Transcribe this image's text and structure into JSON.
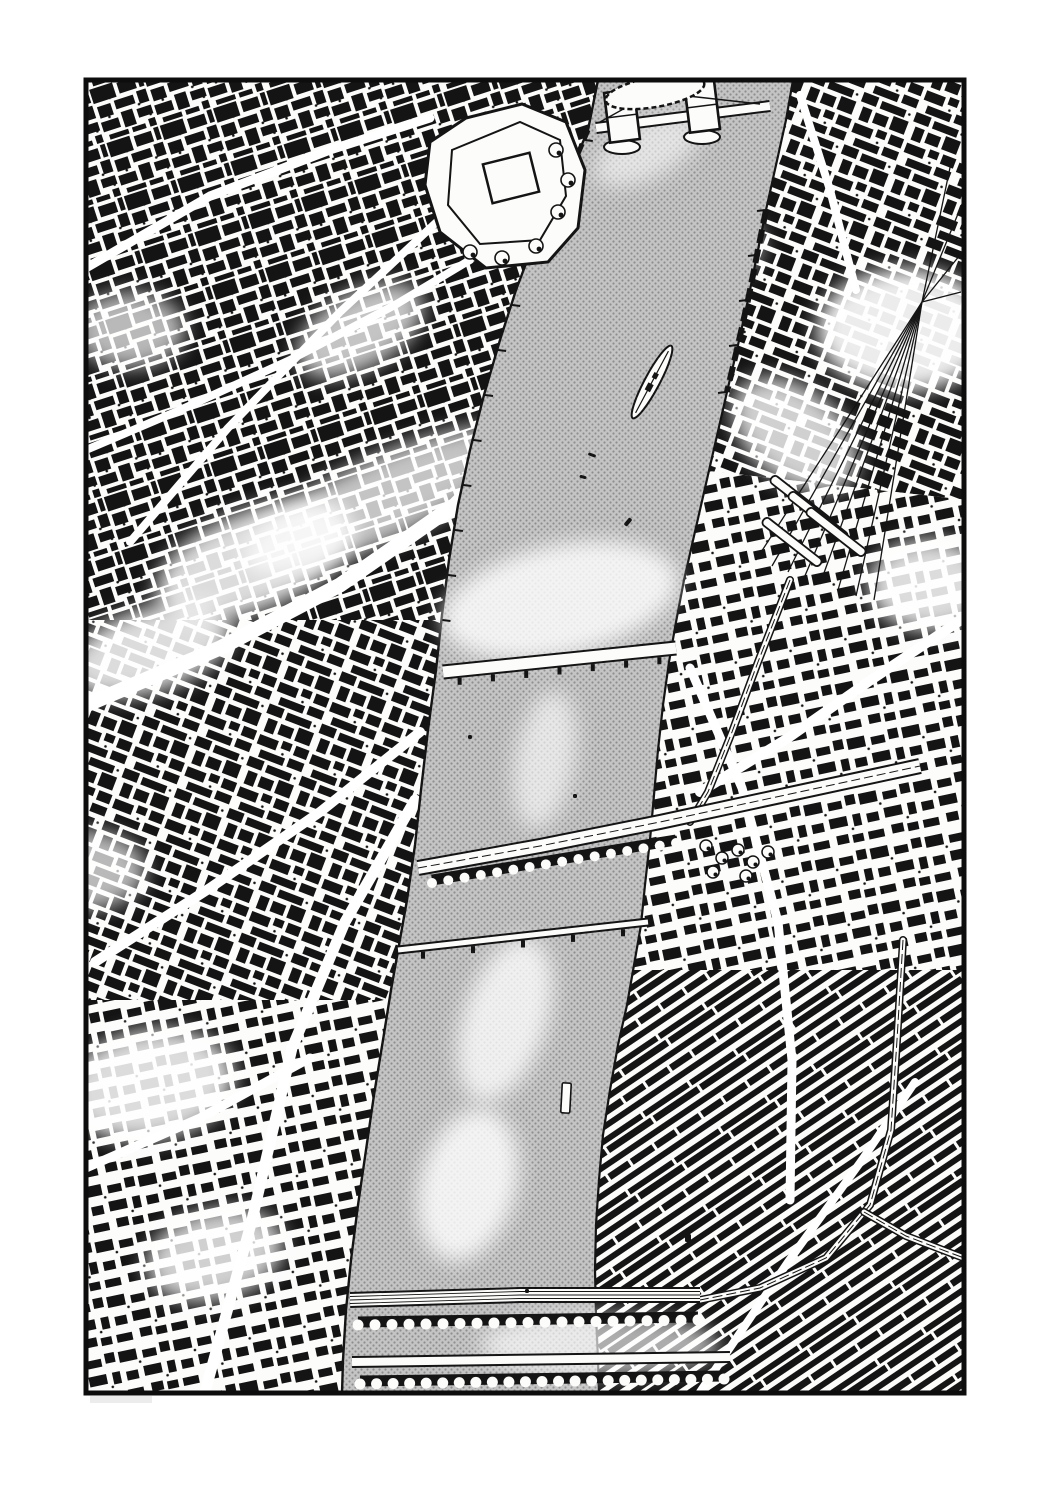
{
  "scene": {
    "type": "aerial-ink-illustration",
    "description": "Black-and-white pen-and-ink aerial panorama of a city bisected by a broad halftone river. A twin-towered bascule bridge and a walled castle compound sit at the top, a moored warship lies on the right bank, a fan of railway tracks feeds a station on the right, and arched rail and road bridges cross near the bottom. Dense hand-drawn city blocks fill both banks inside a black panel border."
  },
  "colors": {
    "ink": "#141414",
    "paper": "#fcfcfb",
    "river_base": "#c4c4c4",
    "river_dot": "#8d8d8d",
    "highlight": "#ffffff",
    "smudge": "#ececec",
    "frame": "#0d0d0d"
  },
  "frame": {
    "x": 86,
    "y": 80,
    "width": 878,
    "height": 1313,
    "border_width": 5
  },
  "river": {
    "left_bank": [
      [
        598,
        80
      ],
      [
        588,
        130
      ],
      [
        572,
        168
      ],
      [
        552,
        205
      ],
      [
        533,
        245
      ],
      [
        516,
        290
      ],
      [
        500,
        340
      ],
      [
        484,
        395
      ],
      [
        470,
        450
      ],
      [
        458,
        505
      ],
      [
        449,
        560
      ],
      [
        442,
        615
      ],
      [
        436,
        670
      ],
      [
        428,
        730
      ],
      [
        421,
        790
      ],
      [
        415,
        845
      ],
      [
        407,
        900
      ],
      [
        399,
        945
      ],
      [
        391,
        990
      ],
      [
        383,
        1040
      ],
      [
        374,
        1095
      ],
      [
        366,
        1150
      ],
      [
        358,
        1205
      ],
      [
        351,
        1260
      ],
      [
        346,
        1310
      ],
      [
        343,
        1360
      ],
      [
        342,
        1393
      ]
    ],
    "right_bank": [
      [
        793,
        80
      ],
      [
        786,
        120
      ],
      [
        776,
        165
      ],
      [
        766,
        210
      ],
      [
        757,
        255
      ],
      [
        748,
        300
      ],
      [
        738,
        345
      ],
      [
        727,
        392
      ],
      [
        716,
        440
      ],
      [
        705,
        488
      ],
      [
        694,
        536
      ],
      [
        684,
        580
      ],
      [
        676,
        622
      ],
      [
        669,
        662
      ],
      [
        663,
        705
      ],
      [
        658,
        750
      ],
      [
        654,
        795
      ],
      [
        650,
        840
      ],
      [
        645,
        885
      ],
      [
        641,
        925
      ],
      [
        634,
        965
      ],
      [
        627,
        1005
      ],
      [
        618,
        1045
      ],
      [
        610,
        1090
      ],
      [
        603,
        1135
      ],
      [
        599,
        1180
      ],
      [
        596,
        1225
      ],
      [
        595,
        1270
      ],
      [
        596,
        1315
      ],
      [
        598,
        1360
      ],
      [
        599,
        1393
      ]
    ]
  },
  "land_regions": [
    {
      "name": "northwest-blocks",
      "pattern": "a",
      "points": [
        [
          83,
          78
        ],
        [
          640,
          78
        ],
        [
          540,
          400
        ],
        [
          470,
          620
        ],
        [
          83,
          620
        ]
      ]
    },
    {
      "name": "west-blocks",
      "pattern": "b",
      "points": [
        [
          83,
          620
        ],
        [
          470,
          620
        ],
        [
          430,
          1000
        ],
        [
          83,
          1000
        ]
      ]
    },
    {
      "name": "southwest-blocks",
      "pattern": "d",
      "points": [
        [
          83,
          1000
        ],
        [
          430,
          1000
        ],
        [
          370,
          1396
        ],
        [
          83,
          1396
        ]
      ]
    },
    {
      "name": "northeast-blocks",
      "pattern": "b",
      "points": [
        [
          760,
          78
        ],
        [
          967,
          78
        ],
        [
          967,
          500
        ],
        [
          700,
          470
        ]
      ]
    },
    {
      "name": "east-blocks",
      "pattern": "d",
      "points": [
        [
          700,
          470
        ],
        [
          967,
          500
        ],
        [
          967,
          970
        ],
        [
          600,
          970
        ]
      ]
    },
    {
      "name": "southeast-terraces",
      "pattern": "c",
      "points": [
        [
          600,
          970
        ],
        [
          967,
          970
        ],
        [
          967,
          1396
        ],
        [
          560,
          1396
        ]
      ]
    }
  ],
  "roads": [
    {
      "width": 9,
      "points": [
        [
          86,
          268
        ],
        [
          210,
          196
        ],
        [
          330,
          150
        ],
        [
          430,
          118
        ]
      ]
    },
    {
      "width": 15,
      "points": [
        [
          86,
          705
        ],
        [
          220,
          648
        ],
        [
          340,
          585
        ],
        [
          455,
          505
        ],
        [
          520,
          440
        ]
      ]
    },
    {
      "width": 10,
      "points": [
        [
          95,
          962
        ],
        [
          210,
          888
        ],
        [
          320,
          812
        ],
        [
          420,
          732
        ]
      ]
    },
    {
      "width": 11,
      "points": [
        [
          205,
          1392
        ],
        [
          252,
          1220
        ],
        [
          292,
          1048
        ],
        [
          345,
          922
        ],
        [
          415,
          800
        ]
      ]
    },
    {
      "width": 8,
      "points": [
        [
          455,
          205
        ],
        [
          340,
          312
        ],
        [
          228,
          428
        ],
        [
          130,
          542
        ]
      ]
    },
    {
      "width": 8,
      "points": [
        [
          86,
          450
        ],
        [
          180,
          410
        ],
        [
          290,
          360
        ],
        [
          395,
          305
        ],
        [
          470,
          260
        ]
      ]
    },
    {
      "width": 9,
      "points": [
        [
          690,
          668
        ],
        [
          742,
          788
        ],
        [
          778,
          922
        ],
        [
          792,
          1060
        ],
        [
          790,
          1200
        ]
      ]
    },
    {
      "width": 10,
      "points": [
        [
          964,
          618
        ],
        [
          868,
          682
        ],
        [
          788,
          738
        ],
        [
          700,
          792
        ]
      ]
    },
    {
      "width": 8,
      "points": [
        [
          700,
          1392
        ],
        [
          788,
          1262
        ],
        [
          862,
          1160
        ],
        [
          915,
          1082
        ]
      ]
    },
    {
      "width": 8,
      "points": [
        [
          800,
          95
        ],
        [
          830,
          190
        ],
        [
          856,
          290
        ]
      ]
    },
    {
      "width": 9,
      "points": [
        [
          86,
          1168
        ],
        [
          200,
          1118
        ],
        [
          310,
          1058
        ]
      ]
    }
  ],
  "land_glows": [
    {
      "cx": 380,
      "cy": 500,
      "rx": 150,
      "ry": 42,
      "rot": -25,
      "o": 0.75
    },
    {
      "cx": 255,
      "cy": 560,
      "rx": 105,
      "ry": 50,
      "rot": -22,
      "o": 0.85
    },
    {
      "cx": 150,
      "cy": 650,
      "rx": 85,
      "ry": 42,
      "rot": -18,
      "o": 0.85
    },
    {
      "cx": 360,
      "cy": 330,
      "rx": 70,
      "ry": 38,
      "rot": -30,
      "o": 0.75
    },
    {
      "cx": 130,
      "cy": 330,
      "rx": 55,
      "ry": 38,
      "rot": 0,
      "o": 0.7
    },
    {
      "cx": 905,
      "cy": 330,
      "rx": 88,
      "ry": 62,
      "rot": 0,
      "o": 0.92
    },
    {
      "cx": 930,
      "cy": 585,
      "rx": 62,
      "ry": 46,
      "rot": 0,
      "o": 0.85
    },
    {
      "cx": 795,
      "cy": 435,
      "rx": 72,
      "ry": 46,
      "rot": 40,
      "o": 0.8
    },
    {
      "cx": 700,
      "cy": 238,
      "rx": 62,
      "ry": 40,
      "rot": 10,
      "o": 0.75
    },
    {
      "cx": 150,
      "cy": 1085,
      "rx": 85,
      "ry": 55,
      "rot": -10,
      "o": 0.85
    },
    {
      "cx": 215,
      "cy": 1255,
      "rx": 70,
      "ry": 45,
      "rot": -15,
      "o": 0.8
    },
    {
      "cx": 460,
      "cy": 1050,
      "rx": 55,
      "ry": 70,
      "rot": 10,
      "o": 0.7
    },
    {
      "cx": 86,
      "cy": 870,
      "rx": 60,
      "ry": 40,
      "rot": 0,
      "o": 0.7
    }
  ],
  "river_glows": [
    {
      "cx": 560,
      "cy": 600,
      "rx": 120,
      "ry": 55,
      "rot": -12,
      "o": 0.8
    },
    {
      "cx": 505,
      "cy": 1020,
      "rx": 85,
      "ry": 42,
      "rot": -72,
      "o": 0.75
    },
    {
      "cx": 468,
      "cy": 1185,
      "rx": 78,
      "ry": 48,
      "rot": -75,
      "o": 0.8
    },
    {
      "cx": 600,
      "cy": 1345,
      "rx": 120,
      "ry": 32,
      "rot": 0,
      "o": 0.65
    },
    {
      "cx": 648,
      "cy": 150,
      "rx": 60,
      "ry": 28,
      "rot": -28,
      "o": 0.55
    },
    {
      "cx": 545,
      "cy": 760,
      "rx": 70,
      "ry": 30,
      "rot": -80,
      "o": 0.6
    }
  ],
  "bridges": {
    "tower_bridge": {
      "deck": [
        [
          596,
          128
        ],
        [
          770,
          106
        ]
      ],
      "deck_width": 12,
      "towers": [
        {
          "cx": 622,
          "cy": 116,
          "w": 30,
          "h": 50,
          "rot": -7
        },
        {
          "cx": 702,
          "cy": 106,
          "w": 30,
          "h": 50,
          "rot": -7
        }
      ]
    },
    "london_bridge": {
      "band": [
        [
          443,
          672
        ],
        [
          676,
          648
        ]
      ],
      "width": 15,
      "piers": 7
    },
    "rail_bridge_mid": {
      "path": [
        [
          418,
          868
        ],
        [
          540,
          846
        ],
        [
          660,
          822
        ],
        [
          790,
          794
        ],
        [
          920,
          766
        ]
      ],
      "width": 16,
      "arches": {
        "from": [
          432,
          880
        ],
        "to": [
          676,
          840
        ],
        "count": 16,
        "r": 5.0
      }
    },
    "southwark_bridge": {
      "band": [
        [
          398,
          950
        ],
        [
          648,
          922
        ]
      ],
      "width": 9,
      "piers": 5
    },
    "rail_bridge_bottom": {
      "path": [
        [
          350,
          1300
        ],
        [
          520,
          1295
        ],
        [
          700,
          1295
        ]
      ],
      "width": 16,
      "arches": {
        "from": [
          358,
          1322
        ],
        "to": [
          698,
          1317
        ],
        "count": 21,
        "r": 5.5
      }
    },
    "road_bridge_bottom": {
      "band": [
        [
          352,
          1362
        ],
        [
          730,
          1357
        ]
      ],
      "width": 12,
      "arches": {
        "from": [
          360,
          1381
        ],
        "to": [
          724,
          1376
        ],
        "count": 23,
        "r": 5.5
      }
    }
  },
  "railways": {
    "fan_origin": [
      922,
      302
    ],
    "fan_ends": [
      [
        756,
        560
      ],
      [
        772,
        566
      ],
      [
        788,
        572
      ],
      [
        804,
        578
      ],
      [
        820,
        584
      ],
      [
        838,
        590
      ],
      [
        856,
        596
      ],
      [
        874,
        600
      ]
    ],
    "fan_upper_ends": [
      [
        952,
        158
      ],
      [
        962,
        204
      ],
      [
        964,
        250
      ],
      [
        961,
        292
      ]
    ],
    "platforms": [
      {
        "cx": 800,
        "cy": 500
      },
      {
        "cx": 818,
        "cy": 516
      },
      {
        "cx": 836,
        "cy": 532
      },
      {
        "cx": 792,
        "cy": 542
      }
    ],
    "platform_size": {
      "w": 72,
      "h": 9,
      "rot": 38
    },
    "viaducts": [
      [
        [
          790,
          580
        ],
        [
          758,
          662
        ],
        [
          732,
          732
        ],
        [
          708,
          792
        ],
        [
          690,
          822
        ]
      ],
      [
        [
          903,
          940
        ],
        [
          897,
          1040
        ],
        [
          891,
          1130
        ],
        [
          870,
          1205
        ],
        [
          826,
          1258
        ],
        [
          760,
          1288
        ],
        [
          700,
          1300
        ]
      ],
      [
        [
          864,
          1212
        ],
        [
          906,
          1236
        ],
        [
          948,
          1252
        ],
        [
          964,
          1258
        ]
      ]
    ]
  },
  "landmarks": {
    "castle_compound": {
      "outer": [
        [
          430,
          142
        ],
        [
          466,
          118
        ],
        [
          522,
          104
        ],
        [
          566,
          122
        ],
        [
          585,
          170
        ],
        [
          578,
          228
        ],
        [
          548,
          262
        ],
        [
          486,
          268
        ],
        [
          440,
          232
        ],
        [
          425,
          185
        ]
      ],
      "inner": [
        [
          452,
          150
        ],
        [
          520,
          122
        ],
        [
          560,
          140
        ],
        [
          566,
          196
        ],
        [
          540,
          240
        ],
        [
          480,
          244
        ],
        [
          448,
          205
        ]
      ],
      "keep": {
        "cx": 511,
        "cy": 178,
        "w": 48,
        "h": 40,
        "rot": -14
      },
      "trees": [
        [
          556,
          150
        ],
        [
          568,
          180
        ],
        [
          558,
          212
        ],
        [
          470,
          252
        ],
        [
          502,
          258
        ],
        [
          536,
          246
        ]
      ]
    },
    "moored_ship": {
      "cx": 652,
      "cy": 382,
      "length": 82,
      "width": 15,
      "rot": -62
    },
    "crescent_terrace": {
      "cx": 655,
      "cy": 92,
      "rx": 50,
      "ry": 15,
      "rot": -10
    },
    "park_trees": [
      [
        706,
        846
      ],
      [
        722,
        858
      ],
      [
        738,
        850
      ],
      [
        753,
        862
      ],
      [
        768,
        852
      ],
      [
        713,
        872
      ],
      [
        746,
        876
      ]
    ]
  },
  "boats": [
    {
      "cx": 592,
      "cy": 455,
      "w": 8,
      "h": 3,
      "rot": 20
    },
    {
      "cx": 583,
      "cy": 477,
      "w": 7,
      "h": 3,
      "rot": 15
    },
    {
      "cx": 628,
      "cy": 522,
      "w": 9,
      "h": 4,
      "rot": -50
    },
    {
      "cx": 575,
      "cy": 796,
      "w": 4,
      "h": 4,
      "rot": 0
    },
    {
      "cx": 470,
      "cy": 737,
      "w": 4,
      "h": 4,
      "rot": 0
    },
    {
      "cx": 566,
      "cy": 1098,
      "w": 9,
      "h": 30,
      "rot": 3
    },
    {
      "cx": 527,
      "cy": 1291,
      "w": 4,
      "h": 4,
      "rot": 0
    },
    {
      "cx": 688,
      "cy": 1238,
      "w": 6,
      "h": 8,
      "rot": 0
    }
  ],
  "quays": {
    "left_tick_ys": [
      140,
      180,
      220,
      262,
      305,
      350,
      395,
      440,
      485,
      530,
      575,
      620
    ],
    "right_tick_ys": [
      210,
      255,
      300,
      345,
      392
    ]
  },
  "smudge": {
    "x": 90,
    "y": 1396,
    "width": 62,
    "height": 7
  }
}
